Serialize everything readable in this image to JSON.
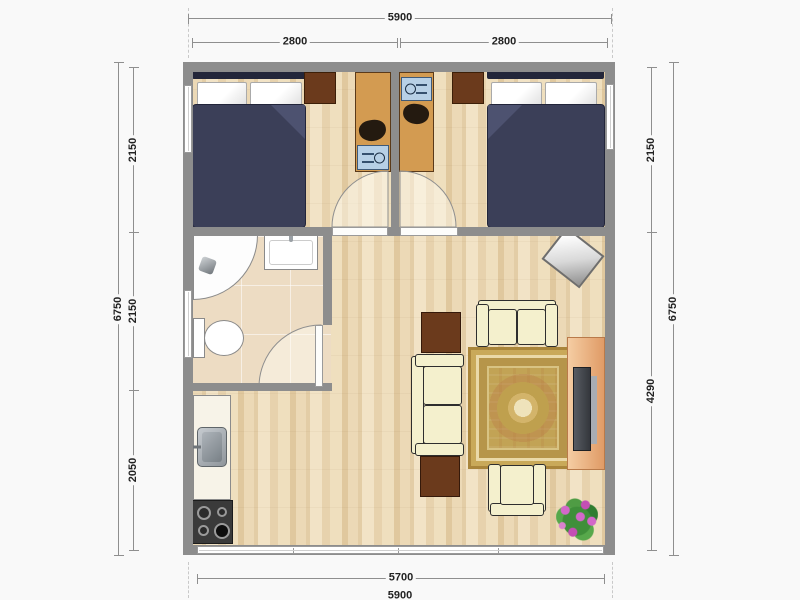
{
  "type": "apartment-floor-plan",
  "dims": {
    "top_total": "5900",
    "top_left": "2800",
    "top_right": "2800",
    "left_outer": "6750",
    "left_top": "2150",
    "left_mid": "2150",
    "left_bottom": "2050",
    "right_outer": "6750",
    "right_top": "2150",
    "right_bottom": "4290",
    "bottom_inner": "5700",
    "bottom_outer": "5900"
  },
  "rooms": [
    "bedroom-left",
    "bedroom-right",
    "bathroom",
    "kitchen",
    "living-room"
  ],
  "furniture": [
    "double-bed",
    "double-bed",
    "desk-with-computer",
    "desk-with-computer",
    "nightstand",
    "nightstand",
    "corner-shower",
    "washbasin",
    "toilet",
    "kitchen-counter",
    "kitchen-sink",
    "gas-stove",
    "sofa",
    "sofa",
    "armchair",
    "coffee-table",
    "coffee-table",
    "oriental-rug",
    "tv-console",
    "tv",
    "corner-mirror",
    "flower-plant"
  ],
  "colors": {
    "wall": "#8d8d8d",
    "wood_floor": "#ecd9b6",
    "tile_floor": "#eddcc3",
    "bed": "#3b3f58",
    "sofa": "#f4f0cd",
    "desk": "#d39b51",
    "table": "#6b3a1c",
    "rug": "#c2a355",
    "console": "#e8ab77",
    "plant_flower": "#d368c9"
  }
}
